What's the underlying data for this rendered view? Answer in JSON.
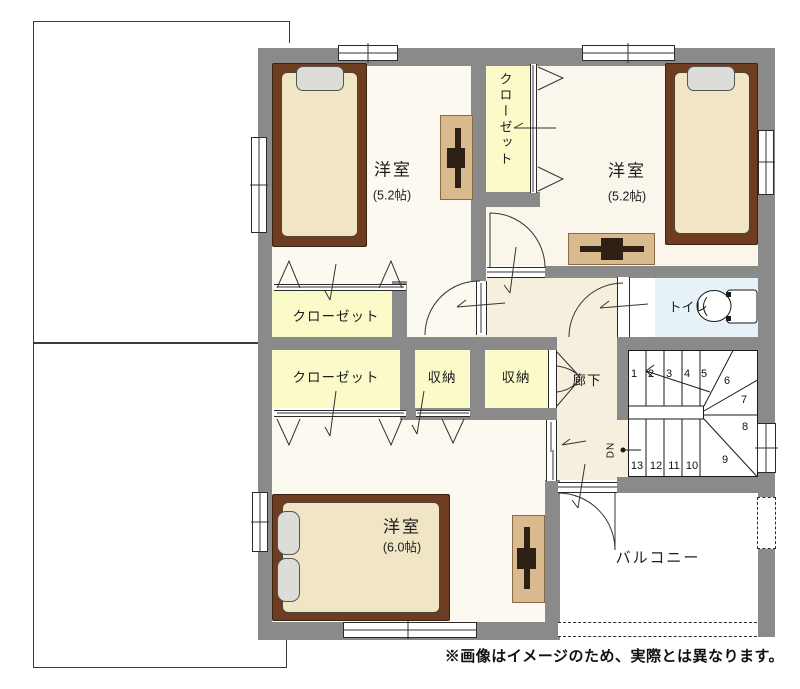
{
  "note": "※画像はイメージのため、実際とは異なります。",
  "rooms": {
    "bedroom_top_left": {
      "name": "洋室",
      "size": "(5.2帖)"
    },
    "bedroom_top_right": {
      "name": "洋室",
      "size": "(5.2帖)"
    },
    "bedroom_bottom": {
      "name": "洋室",
      "size": "(6.0帖)"
    },
    "closet_vertical": "クローゼット",
    "closet_upper": "クローゼット",
    "closet_lower": "クローゼット",
    "storage_left": "収納",
    "storage_right": "収納",
    "hallway": "廊下",
    "toilet": "トイレ",
    "balcony": "バルコニー"
  },
  "stairs": {
    "down_label": "DN",
    "steps": [
      "1",
      "2",
      "3",
      "4",
      "5",
      "6",
      "7",
      "8",
      "9",
      "10",
      "11",
      "12",
      "13"
    ]
  },
  "colors": {
    "wall": "#8a8a8a",
    "room_floor": "#fbf6ec",
    "closet_floor": "#fbfac9",
    "hall_floor": "#f7efdd",
    "toilet_floor": "#e6f2f7",
    "bed_frame": "#6e3c21",
    "mattress": "#f0e5c4",
    "pillow": "#dcdcd8",
    "desk": "#d9ba8f"
  }
}
